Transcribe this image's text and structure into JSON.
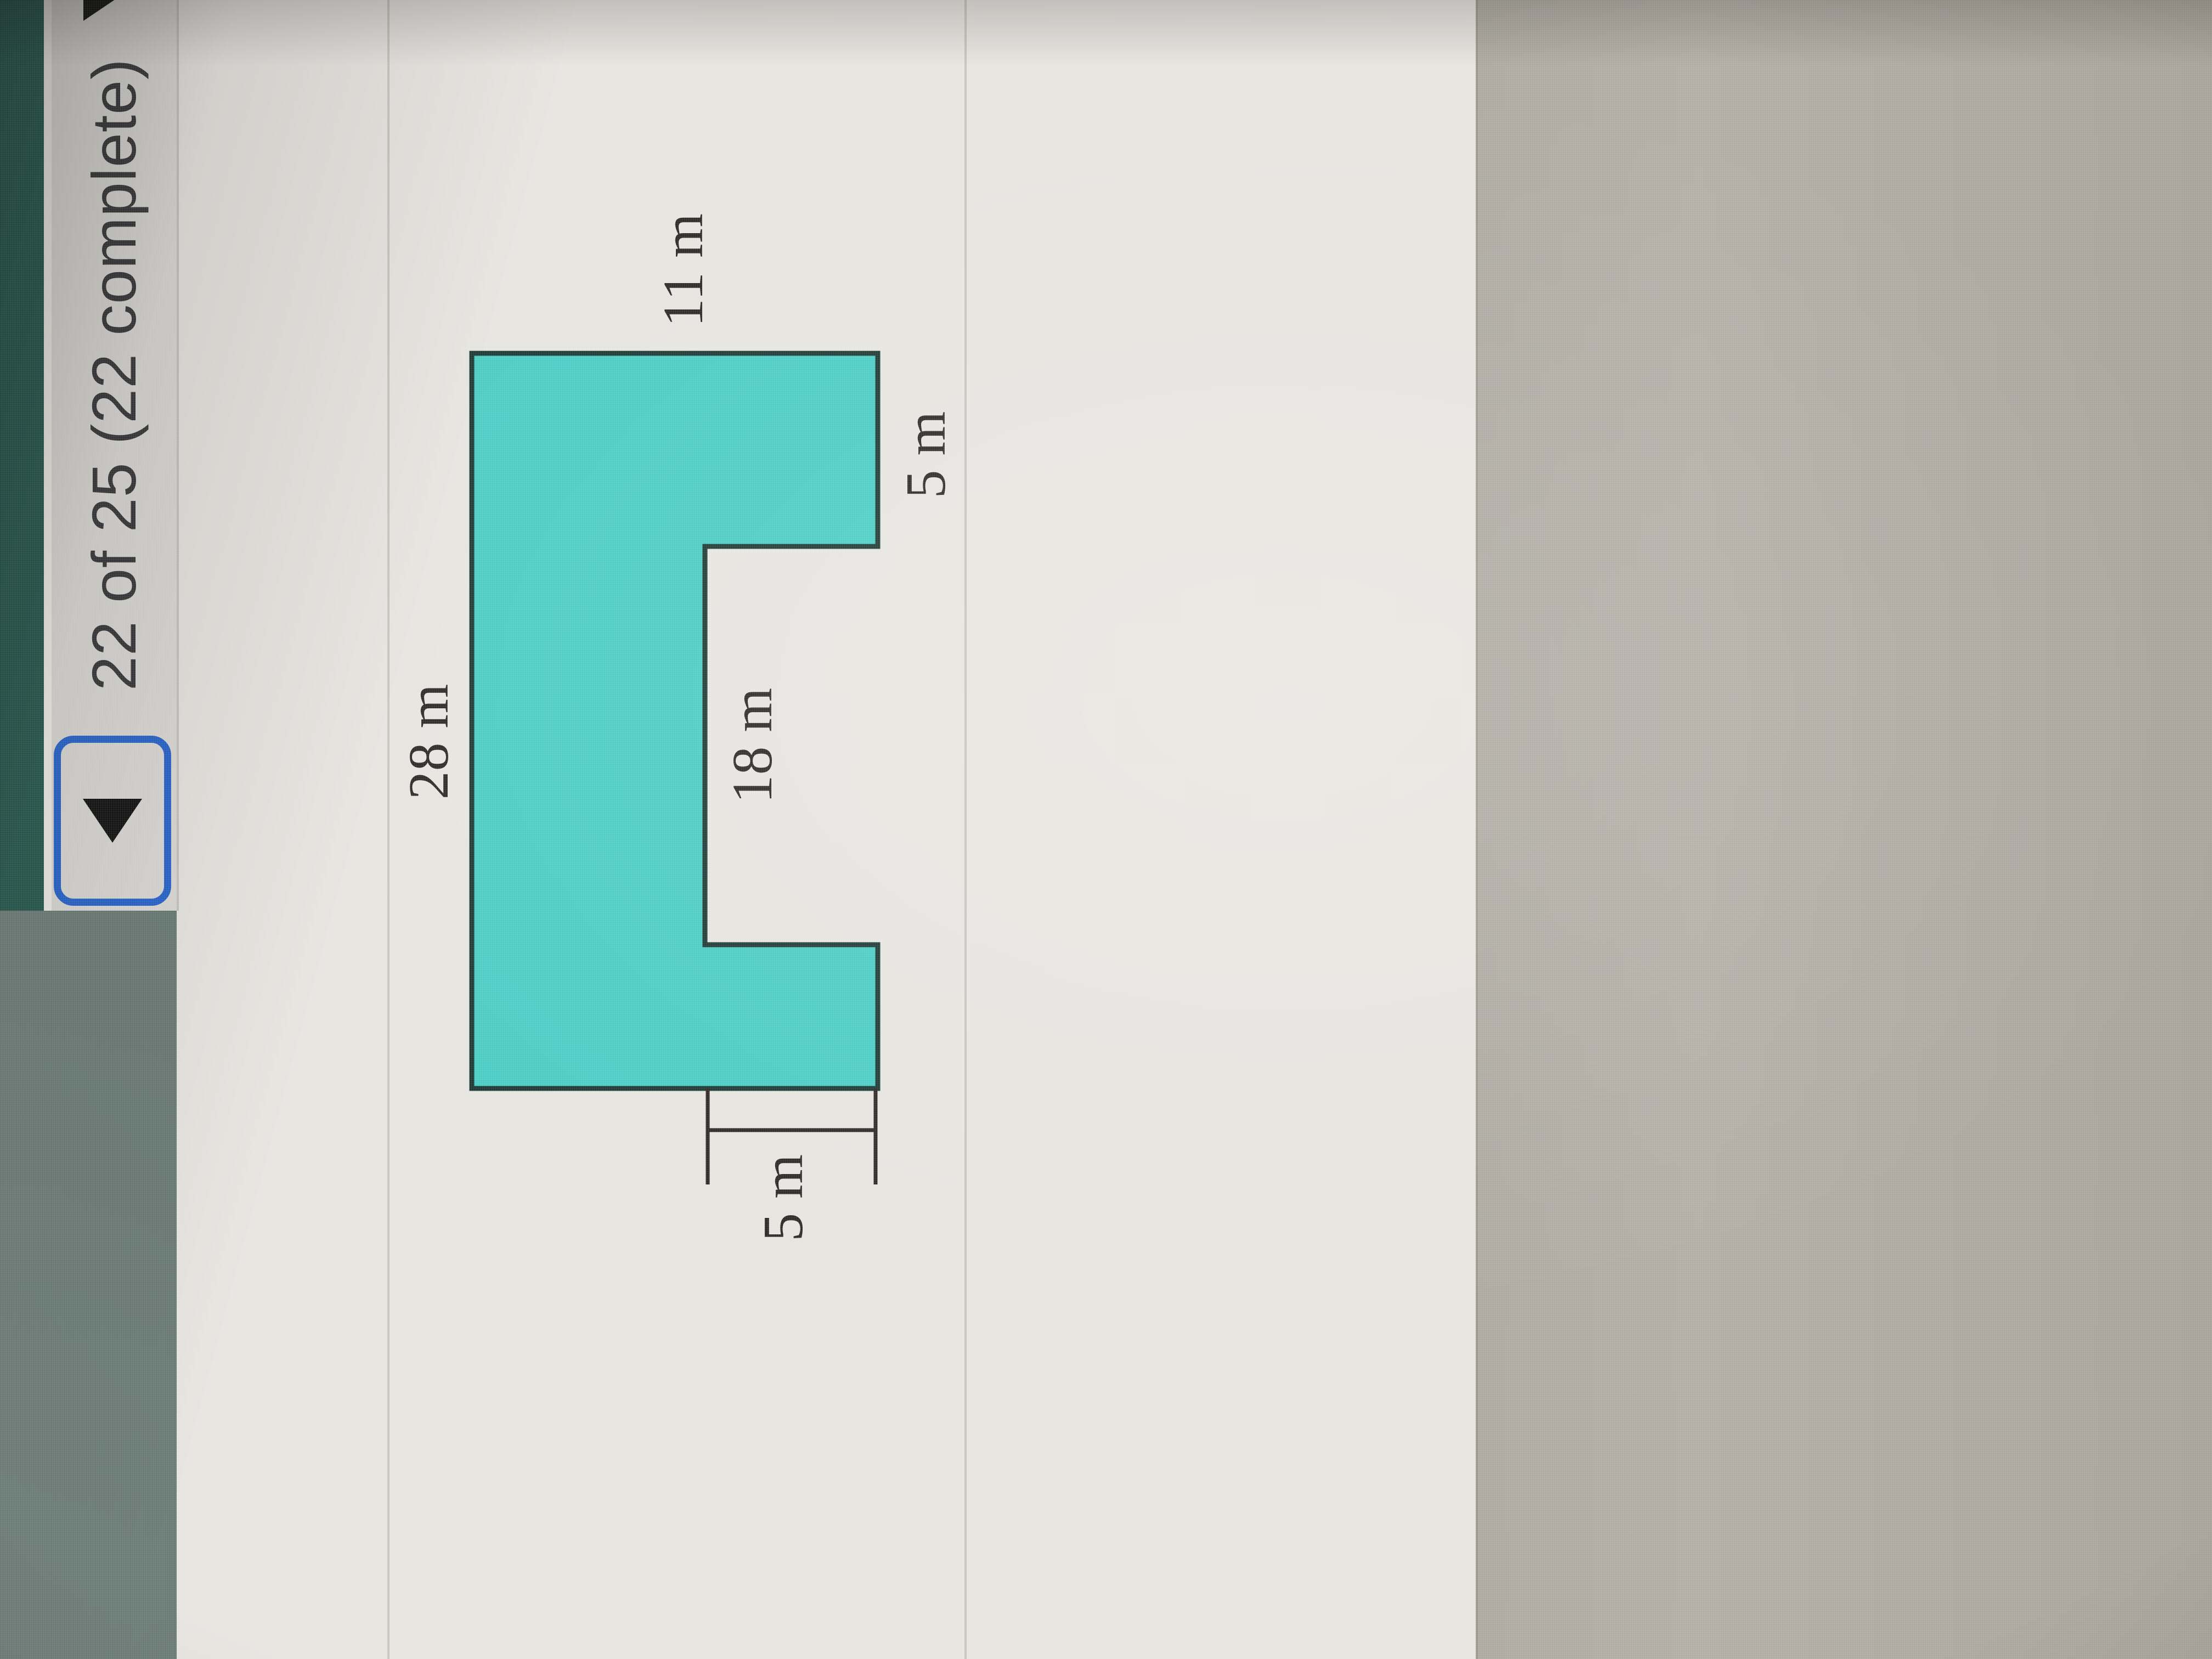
{
  "header": {
    "progress_text": "22 of 25 (22 complete)",
    "prev_button_icon": "left-triangle",
    "dropdown_icon": "down-triangle"
  },
  "figure": {
    "type": "composite-rectilinear-shape",
    "fill_color": "#4ccdc5",
    "outline_color": "#203b37",
    "labels": {
      "top": "28 m",
      "right": "11 m",
      "right_leg": "5 m",
      "notch": "18 m",
      "left_leg": "5 m"
    }
  },
  "colors": {
    "sage_block": "#6f7f79",
    "teal_strip": "#2b5b51",
    "header_bar": "#dcdad6",
    "focus_ring_blue": "#2b66cc",
    "content_background": "#e7e5e0",
    "lower_gray_area": "#b1aca4"
  }
}
